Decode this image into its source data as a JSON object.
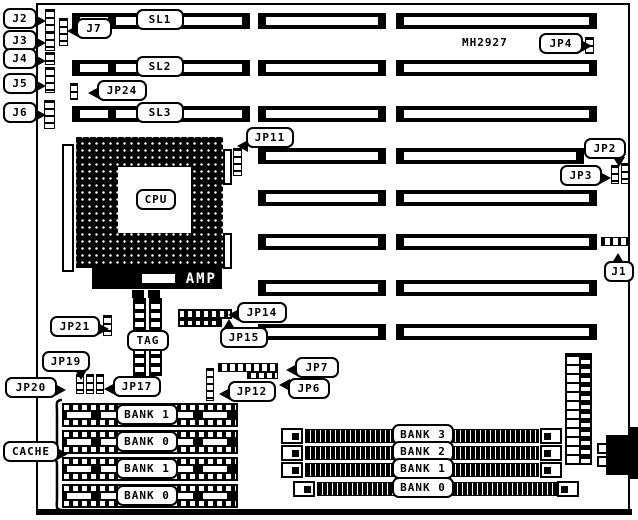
{
  "board": {
    "part_number": "MH2927"
  },
  "labels": {
    "cpu": "CPU",
    "amp": "AMP",
    "tag": "TAG",
    "cache": "CACHE"
  },
  "slot_labels": [
    "SL1",
    "SL2",
    "SL3"
  ],
  "cache_banks": [
    "BANK 1",
    "BANK 0",
    "BANK 1",
    "BANK 0"
  ],
  "simm_banks": [
    "BANK 3",
    "BANK 2",
    "BANK 1",
    "BANK 0"
  ],
  "callouts": [
    {
      "id": "j2",
      "label": "J2",
      "x": 3,
      "y": 8,
      "w": 34,
      "tail": "right"
    },
    {
      "id": "j3",
      "label": "J3",
      "x": 3,
      "y": 30,
      "w": 34,
      "tail": "right"
    },
    {
      "id": "j4",
      "label": "J4",
      "x": 3,
      "y": 48,
      "w": 34,
      "tail": "right"
    },
    {
      "id": "j5",
      "label": "J5",
      "x": 3,
      "y": 73,
      "w": 34,
      "tail": "right"
    },
    {
      "id": "j6",
      "label": "J6",
      "x": 3,
      "y": 102,
      "w": 34,
      "tail": "right"
    },
    {
      "id": "j7",
      "label": "J7",
      "x": 76,
      "y": 18,
      "w": 36,
      "tail": "left"
    },
    {
      "id": "jp24",
      "label": "JP24",
      "x": 97,
      "y": 80,
      "w": 50,
      "tail": "left"
    },
    {
      "id": "jp4",
      "label": "JP4",
      "x": 539,
      "y": 33,
      "w": 44,
      "tail": "right"
    },
    {
      "id": "jp11",
      "label": "JP11",
      "x": 246,
      "y": 127,
      "w": 48,
      "tail": "left",
      "tpos": 80
    },
    {
      "id": "jp2",
      "label": "JP2",
      "x": 584,
      "y": 138,
      "w": 42,
      "tail": "down",
      "tpos": 78
    },
    {
      "id": "jp3",
      "label": "JP3",
      "x": 560,
      "y": 165,
      "w": 42,
      "tail": "right"
    },
    {
      "id": "j1",
      "label": "J1",
      "x": 604,
      "y": 261,
      "w": 30,
      "tail": "up",
      "tpos": 40
    },
    {
      "id": "jp21",
      "label": "JP21",
      "x": 50,
      "y": 316,
      "w": 50,
      "tail": "right"
    },
    {
      "id": "jp19",
      "label": "JP19",
      "x": 42,
      "y": 351,
      "w": 48,
      "tail": "down",
      "tpos": 78
    },
    {
      "id": "jp20",
      "label": "JP20",
      "x": 5,
      "y": 377,
      "w": 52,
      "tail": "right"
    },
    {
      "id": "jp17",
      "label": "JP17",
      "x": 113,
      "y": 376,
      "w": 48,
      "tail": "left"
    },
    {
      "id": "jp14",
      "label": "JP14",
      "x": 237,
      "y": 302,
      "w": 50,
      "tail": "left"
    },
    {
      "id": "jp15",
      "label": "JP15",
      "x": 220,
      "y": 327,
      "w": 48,
      "tail": "up",
      "tpos": 15
    },
    {
      "id": "jp7",
      "label": "JP7",
      "x": 295,
      "y": 357,
      "w": 44,
      "tail": "left"
    },
    {
      "id": "jp6",
      "label": "JP6",
      "x": 288,
      "y": 378,
      "w": 42,
      "tail": "left",
      "tpos": 25
    },
    {
      "id": "jp12",
      "label": "JP12",
      "x": 228,
      "y": 381,
      "w": 48,
      "tail": "left"
    },
    {
      "id": "cache",
      "label": "CACHE",
      "x": 3,
      "y": 441,
      "w": 56,
      "tail": "right"
    },
    {
      "id": "cpu",
      "label": "CPU",
      "x": 136,
      "y": 189,
      "w": 40,
      "tail": "none"
    },
    {
      "id": "tag",
      "label": "TAG",
      "x": 127,
      "y": 330,
      "w": 42,
      "tail": "none"
    }
  ]
}
